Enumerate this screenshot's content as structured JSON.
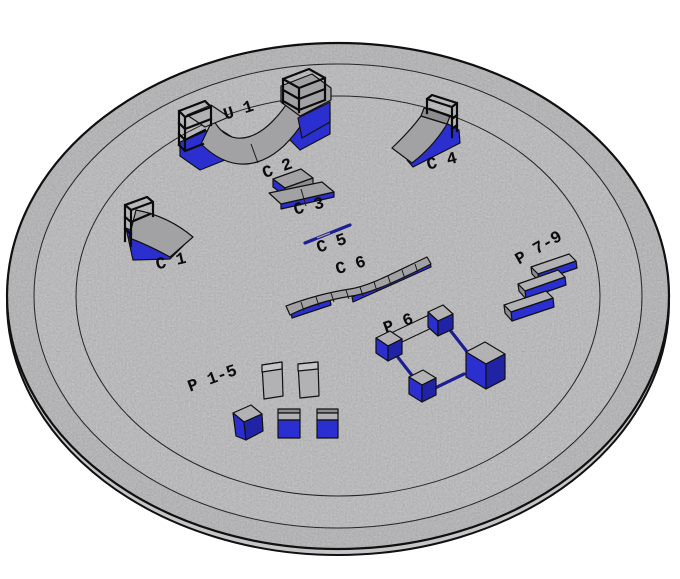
{
  "labels": {
    "u1": "U 1",
    "c1": "C 1",
    "c2": "C 2",
    "c3": "C 3",
    "c4": "C 4",
    "c5": "C 5",
    "c6": "C 6",
    "p15": "P 1-5",
    "p6": "P 6",
    "p79": "P 7-9"
  },
  "colors": {
    "background": "#ffffff",
    "platform": "#d5d5d7",
    "platform_ring": "#cfcfd1",
    "platform_edge": "#c6c6c8",
    "outline": "#111111",
    "obstacle_gray": "#a2a2a4",
    "obstacle_gray_light": "#c6c6c8",
    "obstacle_gray_dark": "#8d8d8f",
    "obstacle_blue": "#2b2fd0",
    "obstacle_blue_dark": "#2023a6",
    "rail_blue": "#1c1f90",
    "label_text": "#0b0b0b"
  }
}
